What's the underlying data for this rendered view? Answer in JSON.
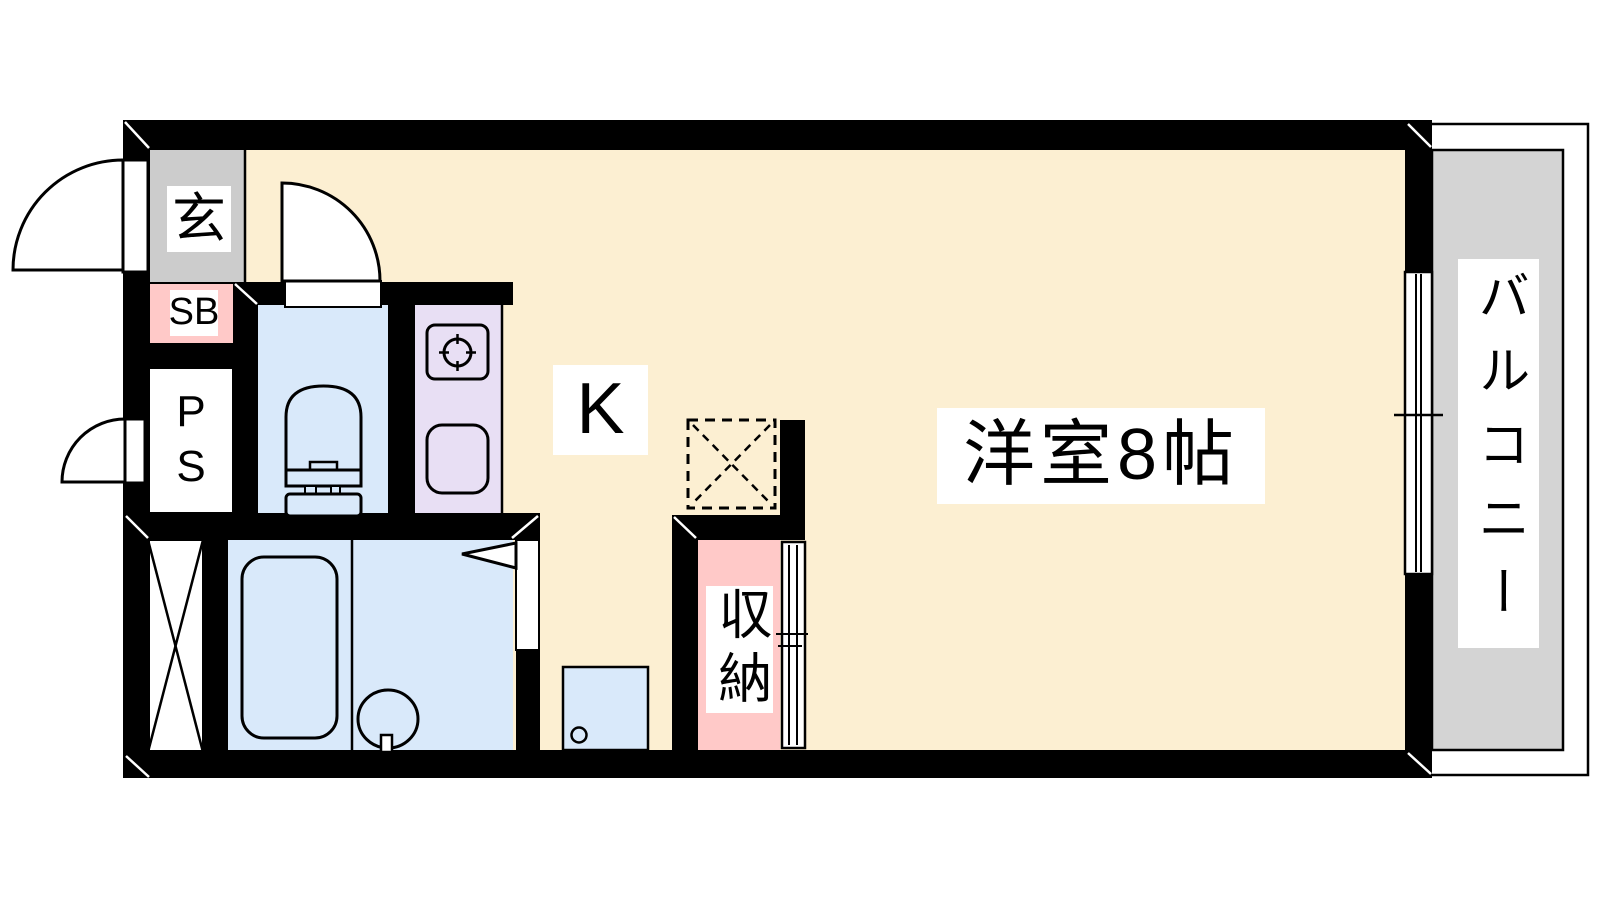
{
  "labels": {
    "entrance": "玄",
    "shoe_box": "SB",
    "pipe_space": "PS",
    "kitchen": "K",
    "closet": "収納",
    "western_room": "洋室8帖",
    "balcony": "バルコニー"
  },
  "palette": {
    "wall": "#000000",
    "floor": "#FCEFD2",
    "entrance_floor": "#CCCCCC",
    "balcony_floor": "#D4D4D4",
    "wet_area": "#D9E9FA",
    "kitchen_counter": "#E8DFF4",
    "storage_pink": "#FFC9C8",
    "label_bg": "#FFFFFF"
  },
  "icons": {
    "toilet": "toilet-icon",
    "bathtub": "bathtub-icon",
    "washbasin": "washbasin-icon",
    "stove": "stove-burner-icon",
    "kitchen_sink": "kitchen-sink-icon",
    "washing_machine_pan": "washing-machine-pan-icon",
    "refrigerator_space": "refrigerator-space-dashed-icon",
    "door_swing": "door-swing-arc-icon",
    "sliding_door": "sliding-door-icon",
    "sliding_window": "sliding-window-icon"
  }
}
